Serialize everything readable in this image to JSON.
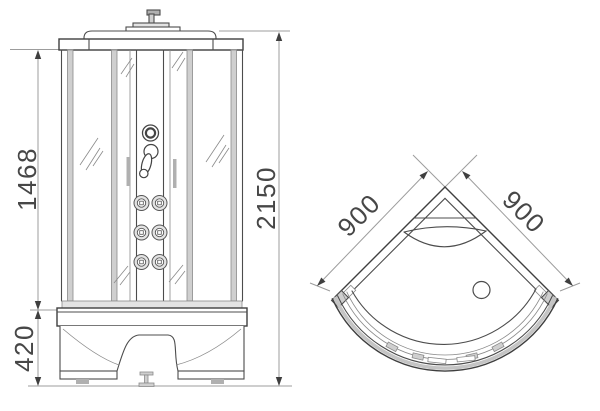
{
  "colors": {
    "background": "#ffffff",
    "outline": "#4c4c4c",
    "dimension_line": "#9c9c9c",
    "dimension_text": "#474747",
    "profile_fill": "#cfcfcf"
  },
  "front_view": {
    "dimensions": {
      "body_height": "1468",
      "overall_height": "2150",
      "tray_height": "420"
    }
  },
  "top_view": {
    "dimensions": {
      "left_wall": "900",
      "right_wall": "900"
    }
  }
}
